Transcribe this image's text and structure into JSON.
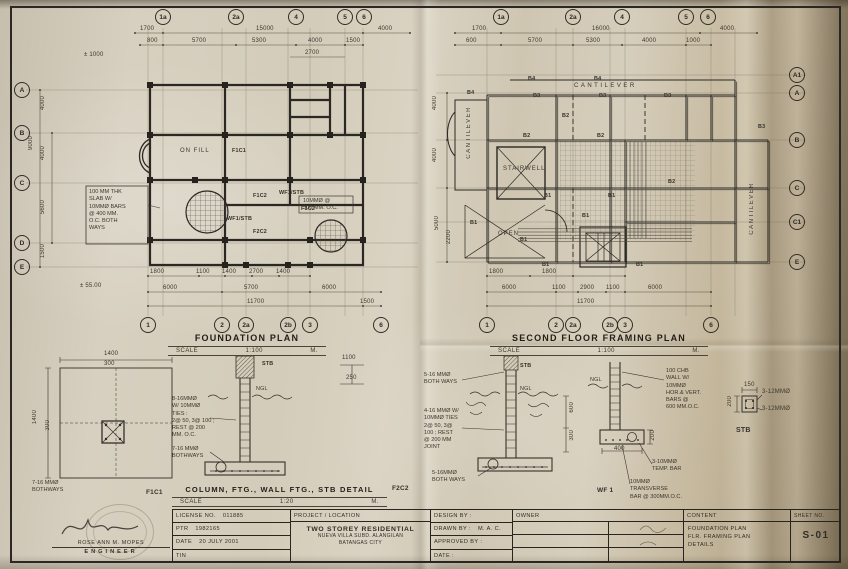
{
  "foundation_plan": {
    "title": "FOUNDATION PLAN",
    "scale_label": "SCALE",
    "scale_value": "1:100",
    "scale_unit": "M.",
    "bubbles_top": [
      "1a",
      "2a",
      "4",
      "5",
      "6"
    ],
    "bubbles_bottom": [
      "1",
      "2",
      "2a",
      "2b",
      "3",
      "6"
    ],
    "bubbles_left": [
      "A",
      "B",
      "C",
      "D",
      "E"
    ],
    "dims_top": [
      "1700",
      "15000",
      "4000"
    ],
    "dims_top2": [
      "800",
      "5700",
      "5300",
      "4000",
      "1500"
    ],
    "dim_2700": "2700",
    "dims_bottom": [
      "1800",
      "1100",
      "1400",
      "2700",
      "1400"
    ],
    "dims_bottom2": [
      "6000",
      "5700",
      "6000"
    ],
    "dims_bottom3": [
      "11700",
      "1500"
    ],
    "benchmark": "± 55.00",
    "benchmark2": "± 1000",
    "dims_left": [
      "4000",
      "4000",
      "9000",
      "5600",
      "1500"
    ],
    "on_fill": "ON FILL",
    "slab_note": "100 MM THK\nSLAB W/\n10MMØ BARS\n@ 400 MM.\nO.C. BOTH\nWAYS",
    "bars_note": "10MMØ @\n300 MM. O.C.",
    "tag_f1c1": "F1C1",
    "tag_f1c2": "F1C2",
    "tag_f2c2": "F2C2",
    "tag_wf1stb": "WF1/STB"
  },
  "framing_plan": {
    "title": "SECOND FLOOR FRAMING PLAN",
    "scale_label": "SCALE",
    "scale_value": "1:100",
    "scale_unit": "M.",
    "bubbles_top": [
      "1a",
      "2a",
      "4",
      "5",
      "6"
    ],
    "bubbles_bottom": [
      "1",
      "2",
      "2a",
      "2b",
      "3",
      "6"
    ],
    "bubbles_right": [
      "A1",
      "A",
      "B",
      "C",
      "C1",
      "E"
    ],
    "dims_top": [
      "1700",
      "16000",
      "4000"
    ],
    "dims_top2": [
      "600",
      "5700",
      "5300",
      "4000",
      "1000"
    ],
    "dims_bottom": [
      "1800",
      "1800"
    ],
    "dims_bottom2": [
      "6000",
      "1100",
      "2900",
      "1100",
      "6000"
    ],
    "dim_11700": "11700",
    "dims_left": [
      "4000",
      "4000",
      "5000",
      "2200"
    ],
    "stairwell": "STAIRWELL",
    "open": "OPEN",
    "cantilever": "CANTILEVER",
    "b1": "B1",
    "b2": "B2",
    "b3": "B3",
    "b4": "B4"
  },
  "details": {
    "title": "COLUMN, FTG., WALL FTG., STB DETAIL",
    "tag": "F2C2",
    "scale_label": "SCALE",
    "scale_value": "1:20",
    "scale_unit": "M.",
    "f1c1_label": "F1C1",
    "wf1_label": "WF 1",
    "stb_label": "STB",
    "stb_top": "STB",
    "ngl": "NGL",
    "dim_1400": "1400",
    "dim_300": "300",
    "dim_1100": "1100",
    "dim_250": "250",
    "dim_600": "600",
    "dim_300b": "300",
    "dim_200": "200",
    "dim_400": "400",
    "dim_150": "150",
    "dim_200s": "200",
    "col_note": "8-16MMØ\nW/ 10MMØ\nTIES :\n2@ 50, 3@ 100 ;\nREST @ 200\nMM. O.C.",
    "bothways_note": "7-16 MMØ\nBOTHWAYS",
    "wall_note": "4-16 MMØ W/\n10MMØ TIES\n2@ 50, 3@\n100 ; REST\n@ 200 MM\nJOINT",
    "w16_note": "5-16 MMØ\nBOTH WAYS",
    "w16b_note": "5-16MMØ\nBOTH WAYS",
    "chb_note": "100 CHB\nWALL W/\n10MMØ\nHOR.& VERT.\nBARS @\n600 MM.O.C.",
    "temp_note": "3-10MMØ\nTEMP. BAR",
    "trans_note": "10MMØ\nTRANSVERSE\nBAR @ 300MM.O.C.",
    "bar12_top": "3-12MMØ",
    "bar12_bot": "3-12MMØ"
  },
  "titleblock": {
    "license_label": "LICENSE  NO.",
    "license_value": "011885",
    "ptr_label": "PTR",
    "ptr_value": "1982165",
    "date_label": "DATE",
    "date_value": "20 JULY 2001",
    "tin_label": "TIN",
    "project_header": "PROJECT  /  LOCATION",
    "project_name": "TWO STOREY RESIDENTIAL",
    "project_loc": "NUEVA VILLA SUBD. ALANGILAN\nBATANGAS CITY",
    "design_by": "DESIGN BY :",
    "drawn_by": "DRAWN BY :",
    "drawn_value": "M. A. C.",
    "approved_by": "APPROVED BY :",
    "date_by": "DATE :",
    "owner": "OWNER",
    "content_header": "CONTENT",
    "content_body": "FOUNDATION PLAN\nFLR. FRAMING PLAN\nDETAILS",
    "sheet_header": "SHEET  NO.",
    "sheet_no": "S-01"
  },
  "engineer": {
    "name": "ROSE ANN M. MOPES",
    "title": "ENGINEER"
  }
}
